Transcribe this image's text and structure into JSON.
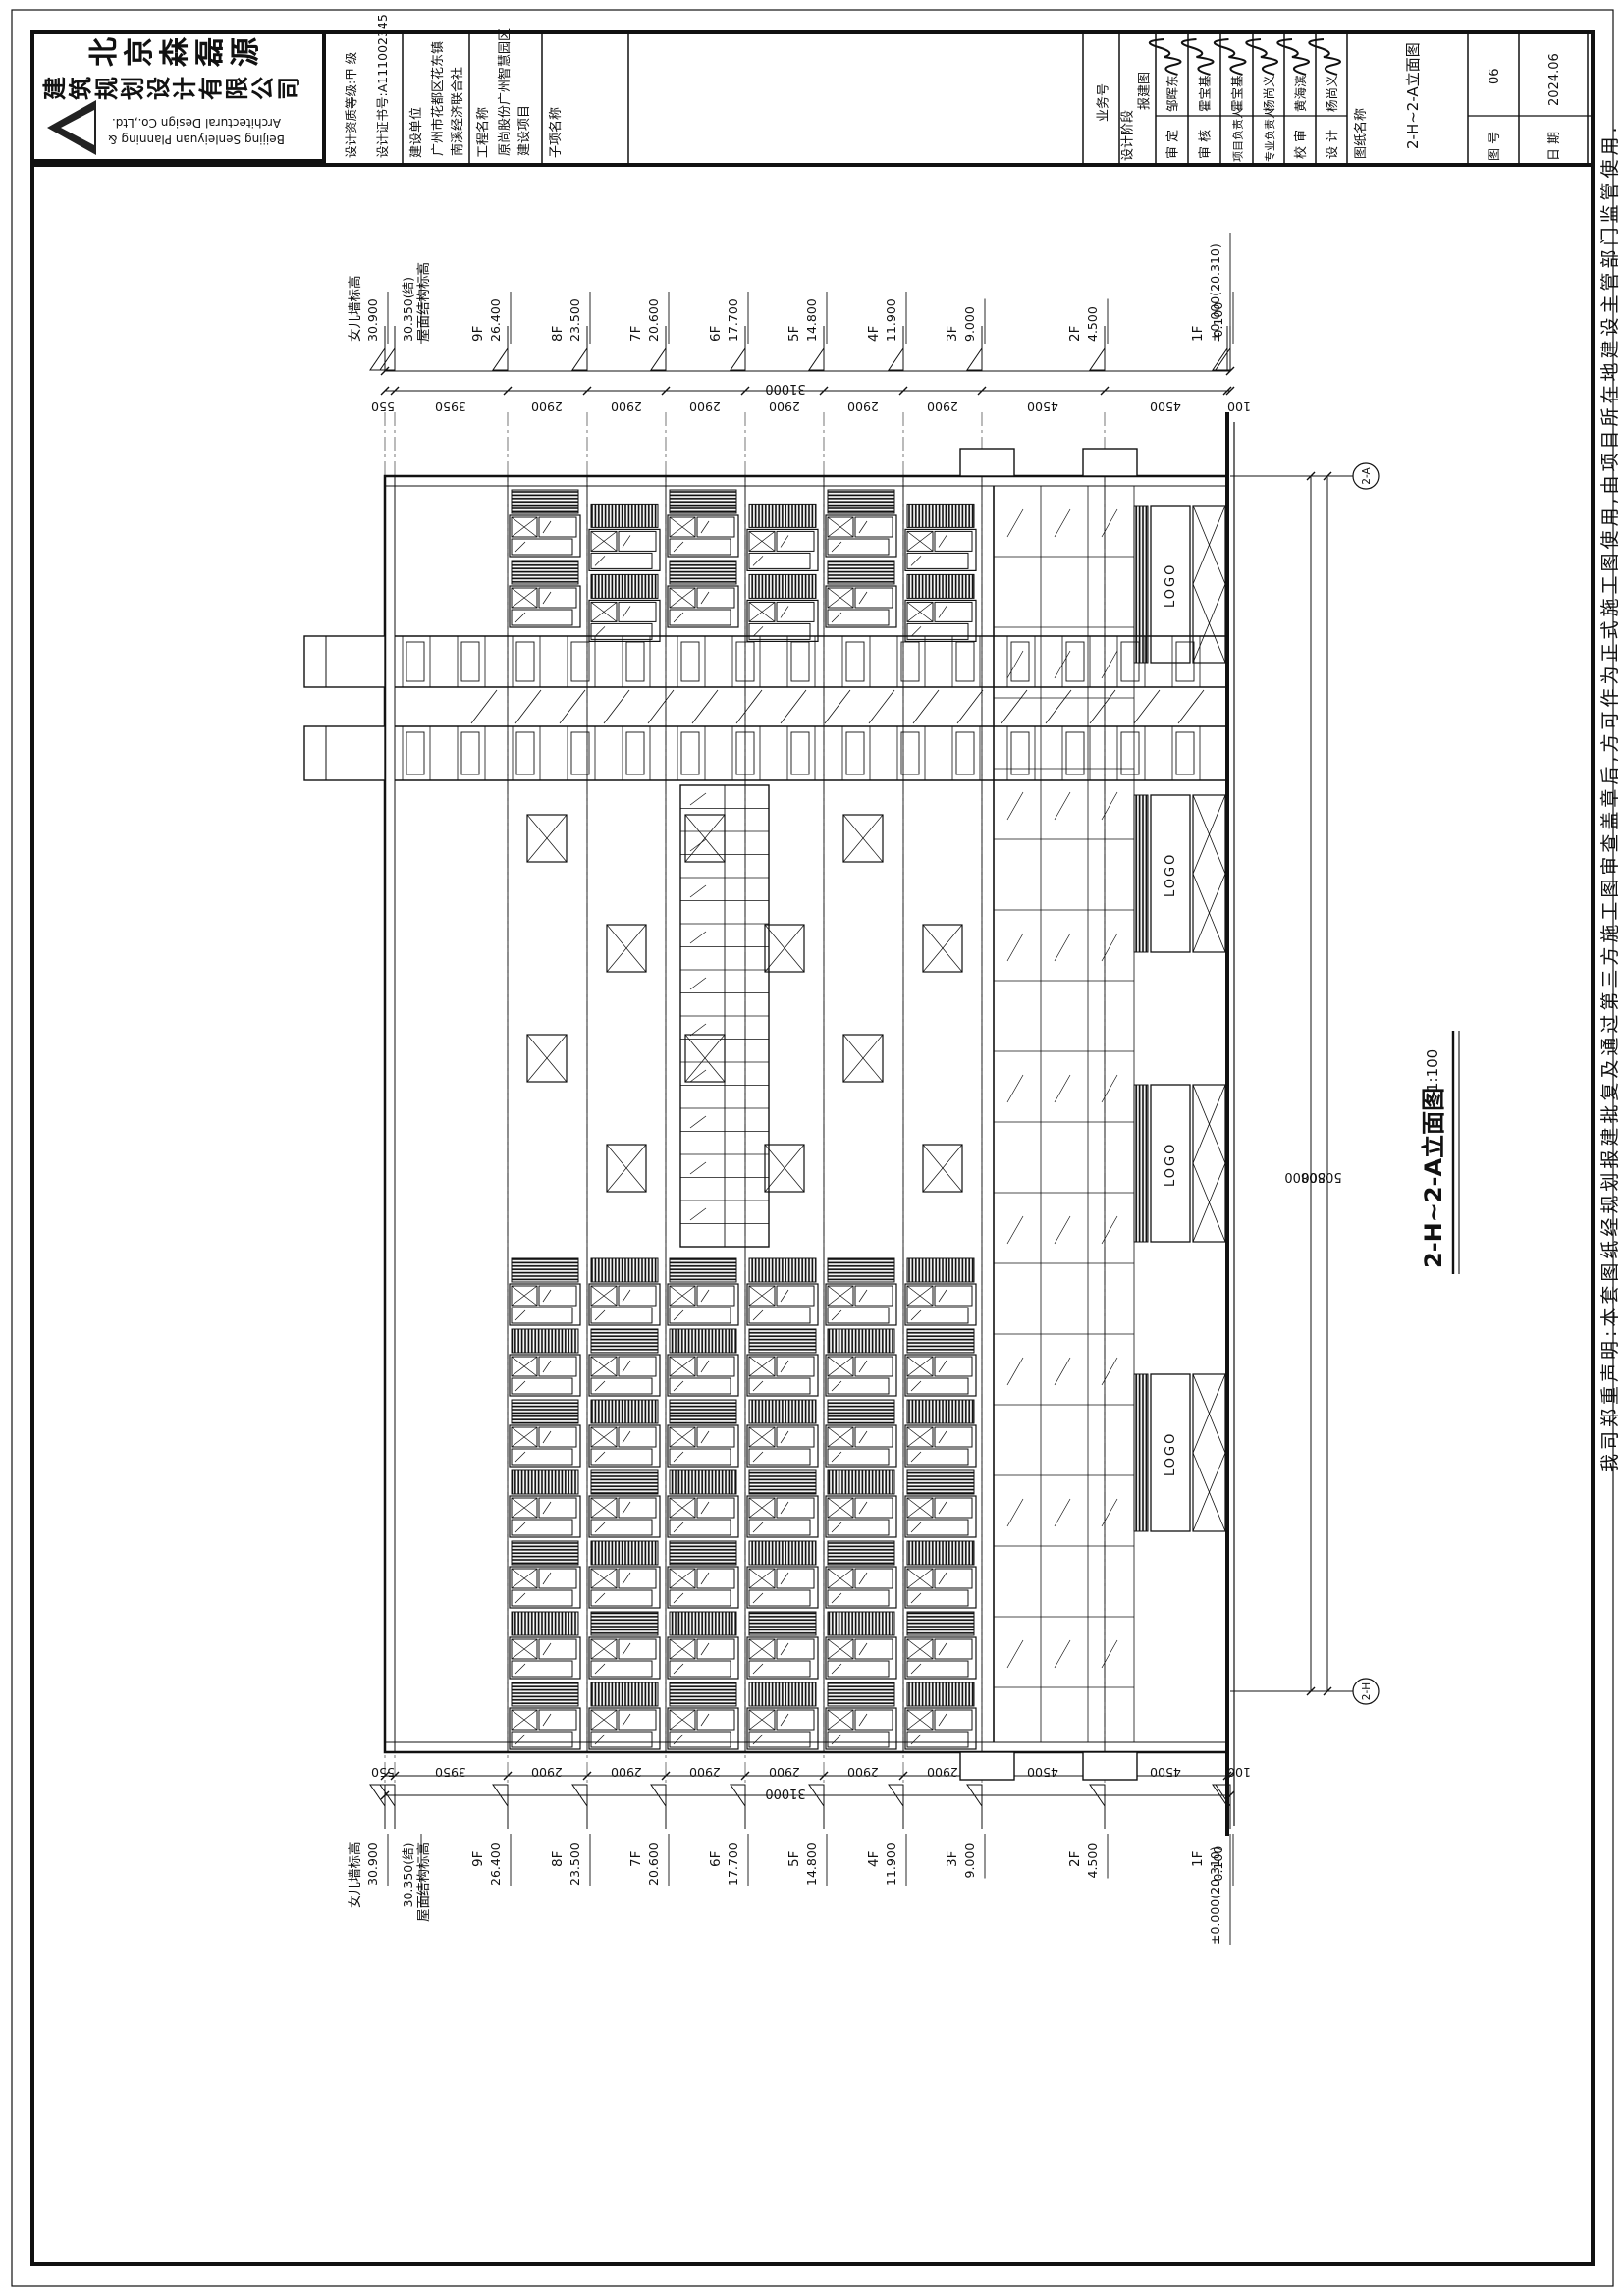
{
  "title_block": {
    "company_cn_line1": "北京森磊源",
    "company_cn_line2": "建筑规划设计有限公司",
    "company_en_line1": "Beijing Senleiyuan Planning &",
    "company_en_line2": "Architectural Design Co.,Ltd.",
    "qualification": "设计资质等级:甲  级",
    "certificate": "设计证书号:A111002345",
    "project_cells": [
      {
        "label": "建设单位",
        "value_lines": [
          "广州市花都区花东镇",
          "南溪经济联合社"
        ]
      },
      {
        "label": "工程名称",
        "value_lines": [
          "原尚股份广州智慧园区",
          "建设项目"
        ]
      },
      {
        "label": "子项名称",
        "value_lines": []
      }
    ],
    "fields": [
      {
        "label": "业务号",
        "value": "",
        "signed": false
      },
      {
        "label": "设计阶段",
        "value": "报建图",
        "signed": false
      },
      {
        "label": "审 定",
        "value": "邹晖东",
        "signed": true
      },
      {
        "label": "审 核",
        "value": "霍宝基",
        "signed": true
      },
      {
        "label": "项目负责人",
        "value": "霍宝基",
        "signed": true
      },
      {
        "label": "专业负责人",
        "value": "杨尚义",
        "signed": true
      },
      {
        "label": "校 审",
        "value": "黄海滨",
        "signed": true
      },
      {
        "label": "设 计",
        "value": "杨尚义",
        "signed": true
      }
    ],
    "sheet_name_label": "图纸名称",
    "sheet_name": "2-H~2-A立面图",
    "sheet_no_label": "图 号",
    "sheet_no": "06",
    "date_label": "日 期",
    "date": "2024.06"
  },
  "margin_note": "我司郑重声明:本套图纸经规划报建批复及通过第三方施工图审查盖章后,方可作为正式施工图使用,由项目所在地建设主管部门监管使用.",
  "drawing": {
    "title": "2-H~2-A立面图",
    "scale": "1:100",
    "grid_bubble_top": "2-A",
    "grid_bubble_bottom": "2-H",
    "overall_dim": "50800",
    "total_dim": "31000",
    "segments": [
      "550",
      "3950",
      "2900",
      "2900",
      "2900",
      "2900",
      "2900",
      "2900",
      "4500",
      "4500",
      "100"
    ],
    "levels": [
      {
        "name": "女儿墙标高",
        "value": "30.900",
        "flip": false
      },
      {
        "name": "屋面结构标高",
        "value": "30.350(结)",
        "flip": true
      },
      {
        "name": "9F",
        "value": "26.400",
        "flip": false
      },
      {
        "name": "8F",
        "value": "23.500",
        "flip": false
      },
      {
        "name": "7F",
        "value": "20.600",
        "flip": false
      },
      {
        "name": "6F",
        "value": "17.700",
        "flip": false
      },
      {
        "name": "5F",
        "value": "14.800",
        "flip": false
      },
      {
        "name": "4F",
        "value": "11.900",
        "flip": false
      },
      {
        "name": "3F",
        "value": "9.000",
        "flip": false
      },
      {
        "name": "2F",
        "value": "4.500",
        "flip": false
      },
      {
        "name": "1F",
        "value": "±0.000(20.310)",
        "flip": false
      },
      {
        "name": "",
        "value": "-0.100",
        "flip": false
      }
    ],
    "logo_sign_text": "LOGO"
  }
}
